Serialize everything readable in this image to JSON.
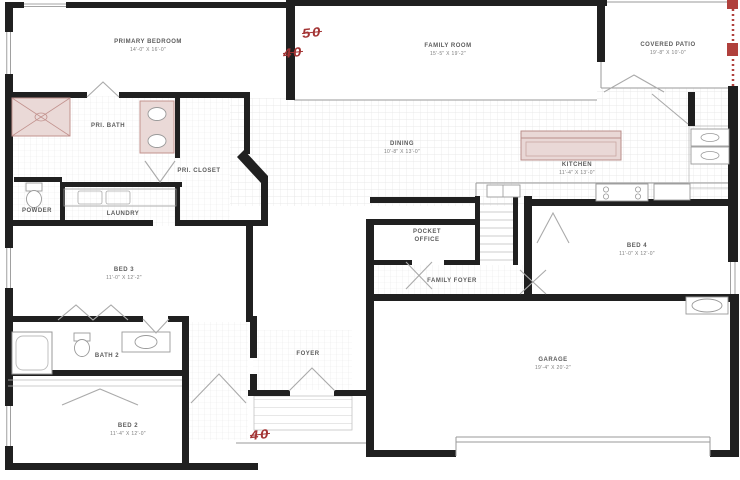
{
  "plan": {
    "type": "residential-floor-plan",
    "rooms": {
      "primary_bedroom": {
        "name": "PRIMARY BEDROOM",
        "dims": "14'-0\" X 16'-0\""
      },
      "family_room": {
        "name": "FAMILY ROOM",
        "dims": "15'-5\" X 19'-2\""
      },
      "covered_patio": {
        "name": "COVERED PATIO",
        "dims": "19'-8\" X 10'-0\""
      },
      "dining": {
        "name": "DINING",
        "dims": "10'-8\" X 13'-0\""
      },
      "kitchen": {
        "name": "KITCHEN",
        "dims": "11'-4\" X 13'-0\""
      },
      "pri_bath": {
        "name": "PRI. BATH",
        "dims": ""
      },
      "pri_closet": {
        "name": "PRI. CLOSET",
        "dims": ""
      },
      "laundry": {
        "name": "LAUNDRY",
        "dims": ""
      },
      "powder": {
        "name": "POWDER",
        "dims": ""
      },
      "pocket_office": {
        "name": "POCKET OFFICE",
        "dims": ""
      },
      "family_foyer": {
        "name": "FAMILY FOYER",
        "dims": ""
      },
      "bed_4": {
        "name": "BED 4",
        "dims": "11'-0\" X 12'-0\""
      },
      "bed_3": {
        "name": "BED 3",
        "dims": "11'-0\" X 12'-2\""
      },
      "bath_2": {
        "name": "BATH 2",
        "dims": ""
      },
      "bed_2": {
        "name": "BED 2",
        "dims": "11'-4\" X 12'-0\""
      },
      "foyer": {
        "name": "FOYER",
        "dims": ""
      },
      "garage": {
        "name": "GARAGE",
        "dims": "19'-4\" X 20'-2\""
      }
    },
    "markers": {
      "crossed_50": "50",
      "crossed_40_top": "40",
      "crossed_40_bottom": "40"
    },
    "fixtures": [
      "shower",
      "double-vanity-sinks",
      "powder-toilet",
      "washer-dryer",
      "bathtub",
      "bath2-toilet",
      "bath2-sink",
      "kitchen-island",
      "kitchen-sink",
      "range",
      "refrigerator",
      "double-oven",
      "water-heater",
      "garage-door",
      "front-door"
    ],
    "colors": {
      "wall": "#202020",
      "fixture_fill": "#ead9d7",
      "fixture_stroke": "#c2928e",
      "marker_red": "#a33434",
      "patio_dash_red": "#b0403c",
      "tile_line": "#e4e4e4",
      "label_text": "#5c5c5c"
    }
  }
}
